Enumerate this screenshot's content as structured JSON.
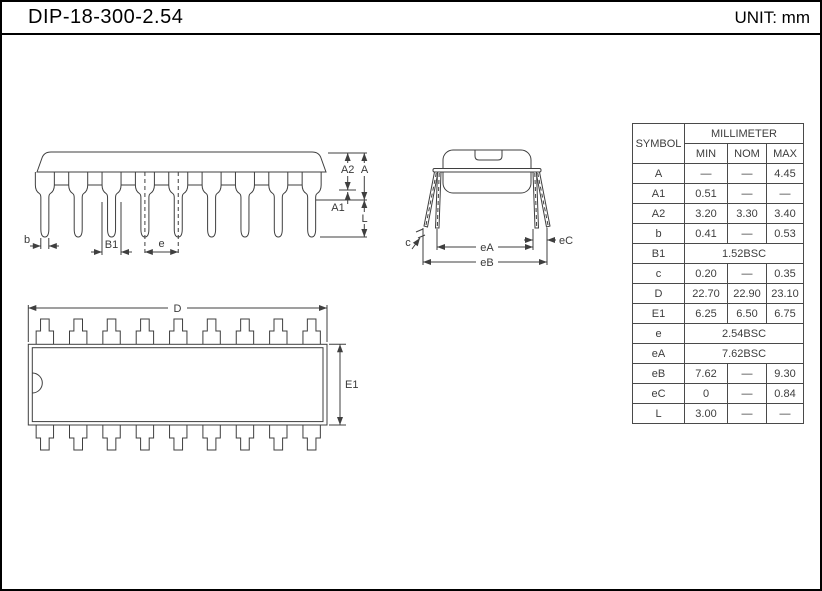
{
  "page": {
    "title": "DIP-18-300-2.54",
    "unit_label": "UNIT: mm"
  },
  "colors": {
    "line": "#3f3f3f",
    "text": "#000000"
  },
  "side_view": {
    "labels": {
      "b": "b",
      "b1": "B1",
      "e": "e",
      "a2": "A2",
      "a": "A",
      "a1": "A1",
      "l": "L"
    }
  },
  "end_view": {
    "labels": {
      "c": "c",
      "ea": "eA",
      "eb": "eB",
      "ec": "eC"
    }
  },
  "top_view": {
    "labels": {
      "d": "D",
      "e1": "E1"
    }
  },
  "table": {
    "headers": {
      "symbol": "SYMBOL",
      "unit_group": "MILLIMETER",
      "min": "MIN",
      "nom": "NOM",
      "max": "MAX"
    },
    "rows": [
      {
        "symbol": "A",
        "min": "—",
        "nom": "—",
        "max": "4.45"
      },
      {
        "symbol": "A1",
        "min": "0.51",
        "nom": "—",
        "max": "—"
      },
      {
        "symbol": "A2",
        "min": "3.20",
        "nom": "3.30",
        "max": "3.40"
      },
      {
        "symbol": "b",
        "min": "0.41",
        "nom": "—",
        "max": "0.53"
      },
      {
        "symbol": "B1",
        "span": "1.52BSC"
      },
      {
        "symbol": "c",
        "min": "0.20",
        "nom": "—",
        "max": "0.35"
      },
      {
        "symbol": "D",
        "min": "22.70",
        "nom": "22.90",
        "max": "23.10"
      },
      {
        "symbol": "E1",
        "min": "6.25",
        "nom": "6.50",
        "max": "6.75"
      },
      {
        "symbol": "e",
        "span": "2.54BSC"
      },
      {
        "symbol": "eA",
        "span": "7.62BSC"
      },
      {
        "symbol": "eB",
        "min": "7.62",
        "nom": "—",
        "max": "9.30"
      },
      {
        "symbol": "eC",
        "min": "0",
        "nom": "—",
        "max": "0.84"
      },
      {
        "symbol": "L",
        "min": "3.00",
        "nom": "—",
        "max": "—"
      }
    ]
  }
}
